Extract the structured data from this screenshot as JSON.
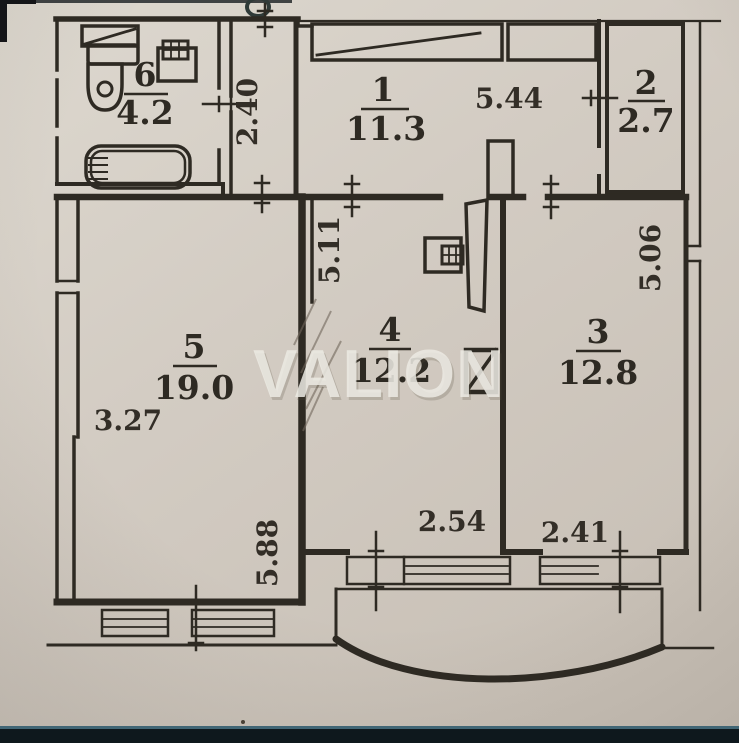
{
  "photo": {
    "watermark": "VALION"
  },
  "plan": {
    "rooms": {
      "room1": {
        "number": "1",
        "area": "11.3"
      },
      "room2": {
        "number": "2",
        "area": "2.7"
      },
      "room3": {
        "number": "3",
        "area": "12.8"
      },
      "room4": {
        "number": "4",
        "area": "12.2"
      },
      "room5": {
        "number": "5",
        "area": "19.0"
      },
      "room6": {
        "number": "6",
        "area": "4.2"
      }
    },
    "dimensions": {
      "corridor_vertical": "2.40",
      "room1_horizontal": "5.44",
      "room4_vertical": "5.11",
      "room5_horizontal": "3.27",
      "room3_vertical": "5.06",
      "room5_vertical": "5.88",
      "room4_bottom": "2.54",
      "room3_bottom": "2.41"
    }
  },
  "colors": {
    "ink": "#2e2a23",
    "paper": "#d3ccc3",
    "watermark": "#edebe4",
    "photo_band": "#0e181d"
  }
}
